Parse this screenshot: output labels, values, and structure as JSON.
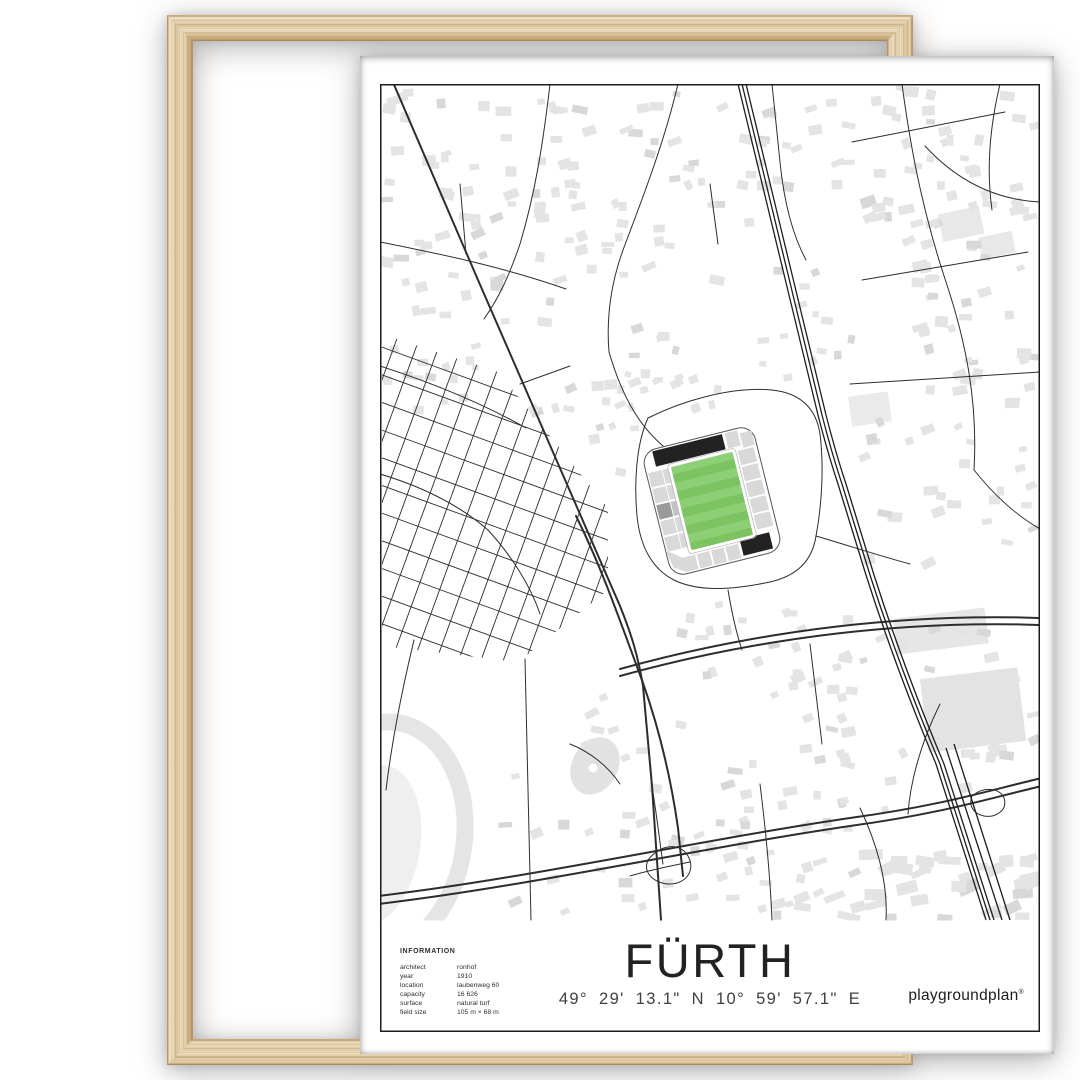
{
  "poster": {
    "title": "FÜRTH",
    "coordinates": "49° 29' 13.1\" N  10° 59' 57.1\" E",
    "brand": "playgroundplan",
    "brand_mark": "®",
    "info": {
      "heading": "INFORMATION",
      "rows": [
        {
          "label": "architect",
          "value": "ronhof"
        },
        {
          "label": "year",
          "value": "1910"
        },
        {
          "label": "location",
          "value": "laubenweg 60"
        },
        {
          "label": "capacity",
          "value": "16 626"
        },
        {
          "label": "surface",
          "value": "natural turf"
        },
        {
          "label": "field size",
          "value": "105 m × 68 m"
        }
      ]
    },
    "map": {
      "stadium": {
        "pitch_color": "#7cc362",
        "pitch_stripe_color": "#8dcf74",
        "stand_color": "#d9d9d9",
        "stand_dark_color": "#222222"
      },
      "road_color": "#2d2d2d",
      "building_color": "#e4e4e4",
      "area_color": "#ececec",
      "border_color": "#1c1c1c"
    },
    "frame": {
      "wood_light": "#f2e5c9",
      "wood_mid": "#e0cba4",
      "wood_dark": "#b3935f"
    }
  }
}
